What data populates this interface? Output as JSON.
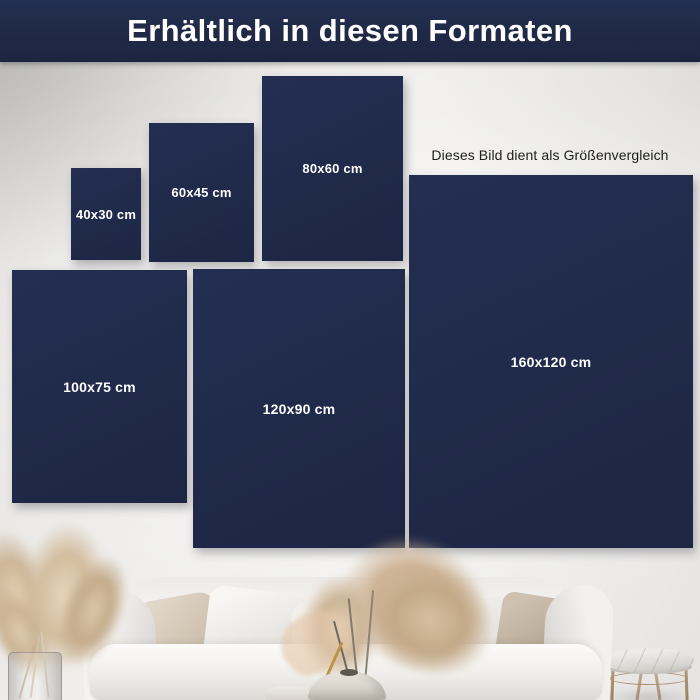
{
  "header": {
    "title": "Erhältlich in diesen Formaten"
  },
  "note": {
    "text": "Dieses Bild dient als Größenvergleich"
  },
  "formats": [
    {
      "label": "40x30 cm"
    },
    {
      "label": "60x45 cm"
    },
    {
      "label": "80x60 cm"
    },
    {
      "label": "100x75 cm"
    },
    {
      "label": "120x90 cm"
    },
    {
      "label": "160x120 cm"
    }
  ],
  "colors": {
    "header_bg": "#1f2946",
    "panel_bg": "#202a4a",
    "panel_text": "#ffffff",
    "note_text": "#1e1e1e",
    "wall": "#efeeec",
    "pampas": "#d3bd9e",
    "table_legs": "#ab9171"
  }
}
